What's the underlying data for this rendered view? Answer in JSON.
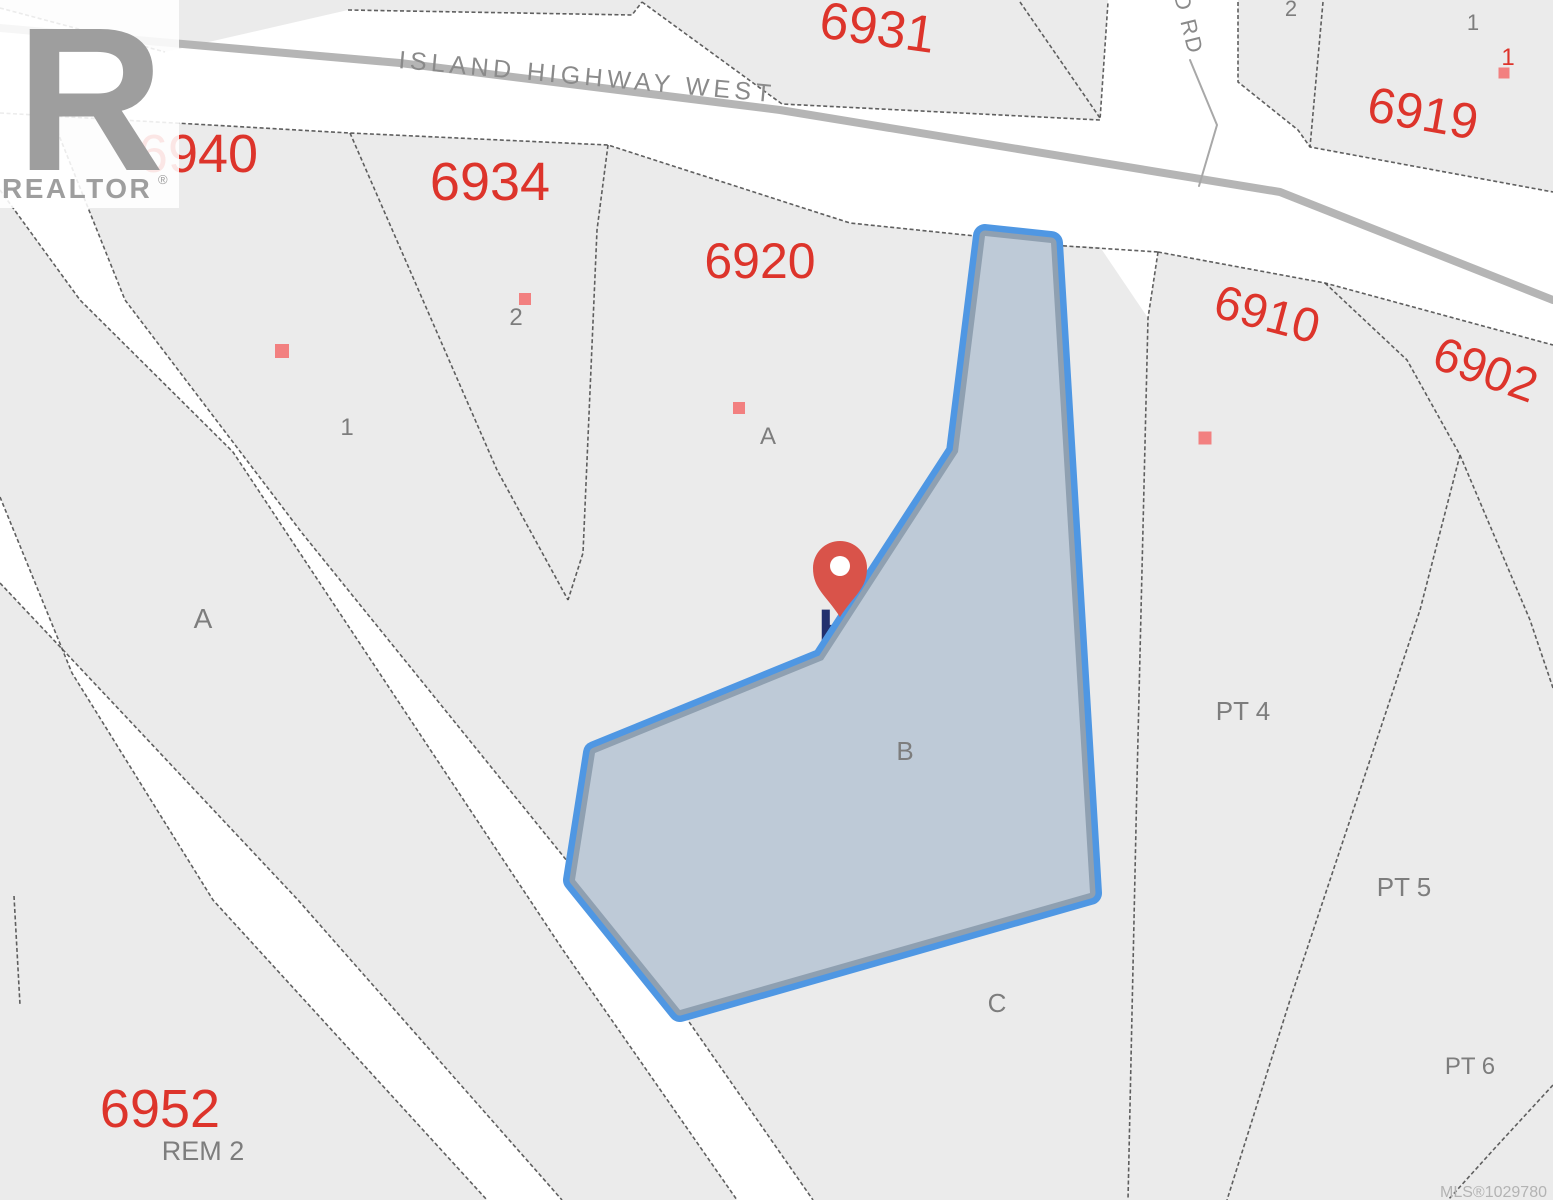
{
  "map": {
    "colors": {
      "background": "#ebebeb",
      "road": "#ffffff",
      "boundary": "#4f4f4f",
      "centerline": "#b5b5b5",
      "drd_centerline": "#a8a8a8",
      "address": "#dd342b",
      "lot_label": "#7d7d7d",
      "road_label": "#8a8a8a",
      "building": "#f28080",
      "highlight_fill": "#becad7",
      "highlight_inner": "#8fa0b1",
      "highlight_outer": "#4f97e3",
      "marker": "#d9534a",
      "marker_label_color": "#22306e",
      "watermark": "#9e9e9e",
      "watermark_box": "#ffffff",
      "mls": "#b3b3b3"
    },
    "roads": [
      {
        "name": "island-highway-west-band",
        "points": "0,8 165,52 348,10 632,15 642,2 782,104 1100,120 1108,0 1238,0 1238,82 1298,130 1310,147 1553,192 1553,345 1325,283 1158,252 1148,318 1100,247 1050,245 985,237 850,223 608,145 350,133 0,113"
      },
      {
        "name": "road-strip-upper",
        "points": "0,113 50,113 125,300 302,533 639,950 813,1200 737,1200 563,950 233,452 80,300 0,190"
      },
      {
        "name": "road-strip-lower",
        "points": "0,497 72,673 213,900 487,1200 562,1200 298,900 129,720 0,583"
      }
    ],
    "boundary_lines": [
      {
        "points": "0,113 350,133 608,145 850,223 985,237"
      },
      {
        "points": "1050,245 1158,252"
      },
      {
        "points": "0,8 165,52"
      },
      {
        "points": "348,10 632,15 642,2"
      },
      {
        "points": "642,2 782,104 1100,120 1108,2"
      },
      {
        "points": "1020,2 1100,118"
      },
      {
        "points": "1238,2 1238,82 1298,130 1310,147 1553,192"
      },
      {
        "points": "1323,2 1310,147"
      },
      {
        "points": "1158,252 1325,283 1553,345"
      },
      {
        "points": "1325,283 1407,360 1460,455"
      },
      {
        "points": "1460,455 1530,620 1553,688"
      },
      {
        "points": "1460,455 1420,610 1290,1000 1227,1200"
      },
      {
        "points": "1553,1085 1495,1148 1448,1200"
      },
      {
        "points": "1158,252 1148,318 1137,780 1128,1200"
      },
      {
        "points": "350,133 497,470 568,600"
      },
      {
        "points": "608,145 597,230 583,553 568,600"
      },
      {
        "points": "0,190 80,300 233,452 563,950 737,1200"
      },
      {
        "points": "50,113 125,300 302,533 639,950 813,1200"
      },
      {
        "points": "0,497 72,673 213,900 487,1200"
      },
      {
        "points": "0,583 129,720 298,900 562,1200"
      },
      {
        "points": "14,896 20,1005"
      }
    ],
    "centerlines": [
      {
        "name": "highway-centerline",
        "points": "0,28 400,63 780,110 1280,192 1553,300",
        "width": 8,
        "color_key": "centerline"
      },
      {
        "name": "side-road-centerline",
        "points": "1190,60 1217,125 1199,186",
        "width": 2,
        "color_key": "drd_centerline"
      }
    ],
    "road_labels": [
      {
        "text": "ISLAND HIGHWAY WEST",
        "x": 398,
        "y": 68,
        "rotate": 5.2,
        "size": 25,
        "spacing": 4.5,
        "anchor": "start"
      },
      {
        "text": "D RD",
        "x": 1174,
        "y": -4,
        "rotate": 76,
        "size": 22,
        "spacing": 2,
        "anchor": "start"
      }
    ],
    "addresses": [
      {
        "text": "6940",
        "x": 198,
        "y": 172,
        "size": 54,
        "rotate": 0
      },
      {
        "text": "6934",
        "x": 490,
        "y": 200,
        "size": 54,
        "rotate": 0
      },
      {
        "text": "6920",
        "x": 760,
        "y": 278,
        "size": 50,
        "rotate": 0
      },
      {
        "text": "6931",
        "x": 875,
        "y": 45,
        "size": 52,
        "rotate": 8
      },
      {
        "text": "6919",
        "x": 1420,
        "y": 130,
        "size": 50,
        "rotate": 10
      },
      {
        "text": "6910",
        "x": 1263,
        "y": 330,
        "size": 48,
        "rotate": 15
      },
      {
        "text": "6902",
        "x": 1480,
        "y": 385,
        "size": 48,
        "rotate": 20
      },
      {
        "text": "6952",
        "x": 160,
        "y": 1127,
        "size": 54,
        "rotate": 0
      }
    ],
    "lot_labels": [
      {
        "text": "A",
        "x": 203,
        "y": 628,
        "size": 28
      },
      {
        "text": "1",
        "x": 347,
        "y": 435,
        "size": 24
      },
      {
        "text": "2",
        "x": 516,
        "y": 325,
        "size": 24
      },
      {
        "text": "A",
        "x": 768,
        "y": 444,
        "size": 24
      },
      {
        "text": "B",
        "x": 905,
        "y": 760,
        "size": 26
      },
      {
        "text": "C",
        "x": 997,
        "y": 1012,
        "size": 26
      },
      {
        "text": "PT 4",
        "x": 1243,
        "y": 720,
        "size": 26
      },
      {
        "text": "PT 5",
        "x": 1404,
        "y": 896,
        "size": 26
      },
      {
        "text": "PT 6",
        "x": 1470,
        "y": 1074,
        "size": 24
      },
      {
        "text": "REM 2",
        "x": 203,
        "y": 1160,
        "size": 27
      },
      {
        "text": "1",
        "x": 1473,
        "y": 30,
        "size": 22
      },
      {
        "text": "2",
        "x": 1291,
        "y": 16,
        "size": 22
      }
    ],
    "unit_labels_red": [
      {
        "text": "1",
        "x": 1508,
        "y": 65,
        "size": 24
      }
    ],
    "buildings": [
      {
        "x": 282,
        "y": 351,
        "size": 14
      },
      {
        "x": 525,
        "y": 299,
        "size": 12
      },
      {
        "x": 739,
        "y": 408,
        "size": 12
      },
      {
        "x": 1205,
        "y": 438,
        "size": 13
      },
      {
        "x": 1504,
        "y": 73,
        "size": 11
      }
    ],
    "selected_parcel": {
      "points": "985,236 1051,243 1090,893 680,1010 575,880 595,753 823,660 958,452",
      "outer_width": 24,
      "inner_width": 11
    },
    "marker": {
      "x": 840,
      "y": 568,
      "tip_y": 617,
      "radius": 27,
      "hole_radius": 10,
      "label": "H",
      "label_x": 818,
      "label_y": 648,
      "label_size": 56
    },
    "watermark": {
      "box": {
        "x": 0,
        "y": 0,
        "w": 179,
        "h": 208
      },
      "letter": "R",
      "brand": "REALTOR",
      "reg": "®"
    },
    "mls_label": {
      "text": "MLS®1029780",
      "x": 1547,
      "y": 1197,
      "size": 16
    }
  }
}
